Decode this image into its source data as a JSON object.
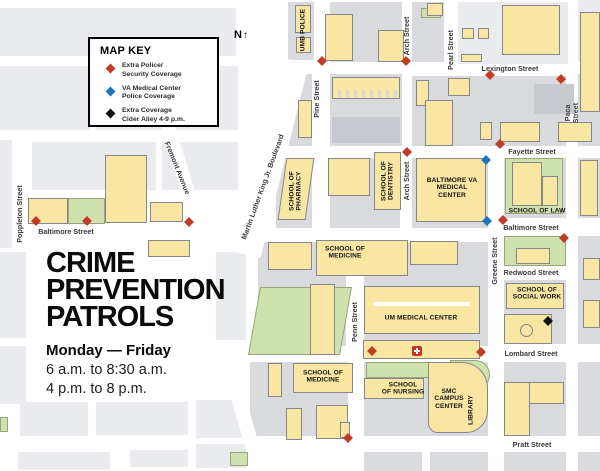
{
  "page": {
    "kind": "campus-crime-prevention-patrol-map"
  },
  "legend": {
    "title": "MAP KEY",
    "items": [
      {
        "marker": "extra-police",
        "color": "#c23b27",
        "label": "Extra Police/\nSecurity Coverage"
      },
      {
        "marker": "va-police",
        "color": "#1c75bc",
        "label": "VA Medical Center\nPolice Coverage"
      },
      {
        "marker": "cider-alley",
        "color": "#111111",
        "label": "Extra Coverage\nCider Alley 4-9 p.m."
      }
    ]
  },
  "north_arrow": {
    "label": "N",
    "glyph": "↑"
  },
  "title_block": {
    "line1": "CRIME",
    "line2": "PREVENTION",
    "line3": "PATROLS",
    "schedule_title": "Monday — Friday",
    "schedule_line1": "6 a.m. to 8:30 a.m.",
    "schedule_line2": "4 p.m. to 8 p.m."
  },
  "map": {
    "street_labels": [
      {
        "name": "lexington-street",
        "text": "Lexington Street",
        "x": 510,
        "y": 69,
        "rotate": 0
      },
      {
        "name": "fayette-street",
        "text": "Fayette Street",
        "x": 532,
        "y": 152,
        "rotate": 0
      },
      {
        "name": "baltimore-street-west",
        "text": "Baltimore Street",
        "x": 66,
        "y": 232,
        "rotate": 0
      },
      {
        "name": "baltimore-street-east",
        "text": "Baltimore Street",
        "x": 531,
        "y": 228,
        "rotate": 0
      },
      {
        "name": "redwood-street",
        "text": "Redwood Street",
        "x": 531,
        "y": 273,
        "rotate": 0
      },
      {
        "name": "lombard-street",
        "text": "Lombard Street",
        "x": 531,
        "y": 354,
        "rotate": 0
      },
      {
        "name": "pratt-street",
        "text": "Pratt Street",
        "x": 532,
        "y": 445,
        "rotate": 0
      },
      {
        "name": "poppleton-street",
        "text": "Poppleton Street",
        "x": 20,
        "y": 214,
        "rotate": -90
      },
      {
        "name": "pine-street",
        "text": "Pine Street",
        "x": 317,
        "y": 99,
        "rotate": -90
      },
      {
        "name": "arch-street-north",
        "text": "Arch Street",
        "x": 407,
        "y": 36,
        "rotate": -90
      },
      {
        "name": "arch-street-mid",
        "text": "Arch Street",
        "x": 407,
        "y": 181,
        "rotate": -90
      },
      {
        "name": "pearl-street",
        "text": "Pearl Street",
        "x": 451,
        "y": 50,
        "rotate": -90
      },
      {
        "name": "paca-street",
        "text": "Paca Street",
        "x": 572,
        "y": 113,
        "rotate": -90
      },
      {
        "name": "penn-street",
        "text": "Penn Street",
        "x": 355,
        "y": 322,
        "rotate": -90
      },
      {
        "name": "greene-street",
        "text": "Greene Street",
        "x": 495,
        "y": 261,
        "rotate": -90
      },
      {
        "name": "fremont-avenue",
        "text": "Fremont Avenue",
        "x": 177,
        "y": 168,
        "rotate": 68
      },
      {
        "name": "mlk-boulevard",
        "text": "Martin Luther King Jr. Boulevard",
        "x": 263,
        "y": 187,
        "rotate": -70
      }
    ],
    "building_labels": [
      {
        "name": "umb-police",
        "text": "UMB POLICE",
        "x": 303,
        "y": 30,
        "rotate": -90
      },
      {
        "name": "school-of-pharmacy",
        "text": "SCHOOL OF\nPHARMACY",
        "x": 296,
        "y": 191,
        "rotate": -90
      },
      {
        "name": "school-of-dentistry",
        "text": "SCHOOL OF\nDENTISTRY",
        "x": 388,
        "y": 181,
        "rotate": -90
      },
      {
        "name": "baltimore-va-medical-center",
        "text": "BALTIMORE VA\nMEDICAL\nCENTER",
        "x": 452,
        "y": 188,
        "rotate": 0
      },
      {
        "name": "school-of-law",
        "text": "SCHOOL OF LAW",
        "x": 537,
        "y": 211,
        "rotate": 0
      },
      {
        "name": "school-of-medicine-north",
        "text": "SCHOOL OF\nMEDICINE",
        "x": 345,
        "y": 253,
        "rotate": 0
      },
      {
        "name": "um-medical-center",
        "text": "UM MEDICAL CENTER",
        "x": 421,
        "y": 318,
        "rotate": 0
      },
      {
        "name": "school-of-social-work",
        "text": "SCHOOL OF\nSOCIAL WORK",
        "x": 537,
        "y": 294,
        "rotate": 0
      },
      {
        "name": "school-of-medicine-south",
        "text": "SCHOOL OF\nMEDICINE",
        "x": 323,
        "y": 377,
        "rotate": 0
      },
      {
        "name": "school-of-nursing",
        "text": "SCHOOL\nOF NURSING",
        "x": 403,
        "y": 389,
        "rotate": 0
      },
      {
        "name": "smc-campus-center",
        "text": "SMC\nCAMPUS\nCENTER",
        "x": 449,
        "y": 399,
        "rotate": 0
      },
      {
        "name": "library",
        "text": "LIBRARY",
        "x": 471,
        "y": 410,
        "rotate": -90
      }
    ],
    "markers": [
      {
        "type": "extra-police",
        "x": 322,
        "y": 61
      },
      {
        "type": "extra-police",
        "x": 406,
        "y": 61
      },
      {
        "type": "extra-police",
        "x": 490,
        "y": 75
      },
      {
        "type": "extra-police",
        "x": 561,
        "y": 79
      },
      {
        "type": "extra-police",
        "x": 500,
        "y": 144
      },
      {
        "type": "extra-police",
        "x": 407,
        "y": 152
      },
      {
        "type": "extra-police",
        "x": 36,
        "y": 221
      },
      {
        "type": "extra-police",
        "x": 87,
        "y": 221
      },
      {
        "type": "extra-police",
        "x": 189,
        "y": 222
      },
      {
        "type": "extra-police",
        "x": 503,
        "y": 220
      },
      {
        "type": "extra-police",
        "x": 564,
        "y": 238
      },
      {
        "type": "extra-police",
        "x": 372,
        "y": 351
      },
      {
        "type": "extra-police",
        "x": 481,
        "y": 352
      },
      {
        "type": "extra-police",
        "x": 348,
        "y": 438
      },
      {
        "type": "va-police",
        "x": 486,
        "y": 160
      },
      {
        "type": "va-police",
        "x": 487,
        "y": 221
      },
      {
        "type": "cider-alley",
        "x": 548,
        "y": 321
      },
      {
        "type": "hospital",
        "x": 417,
        "y": 351
      }
    ],
    "marker_colors": {
      "extra-police": "#c23b27",
      "va-police": "#1c75bc",
      "cider-alley": "#111111",
      "hospital": "#c9342a"
    }
  }
}
